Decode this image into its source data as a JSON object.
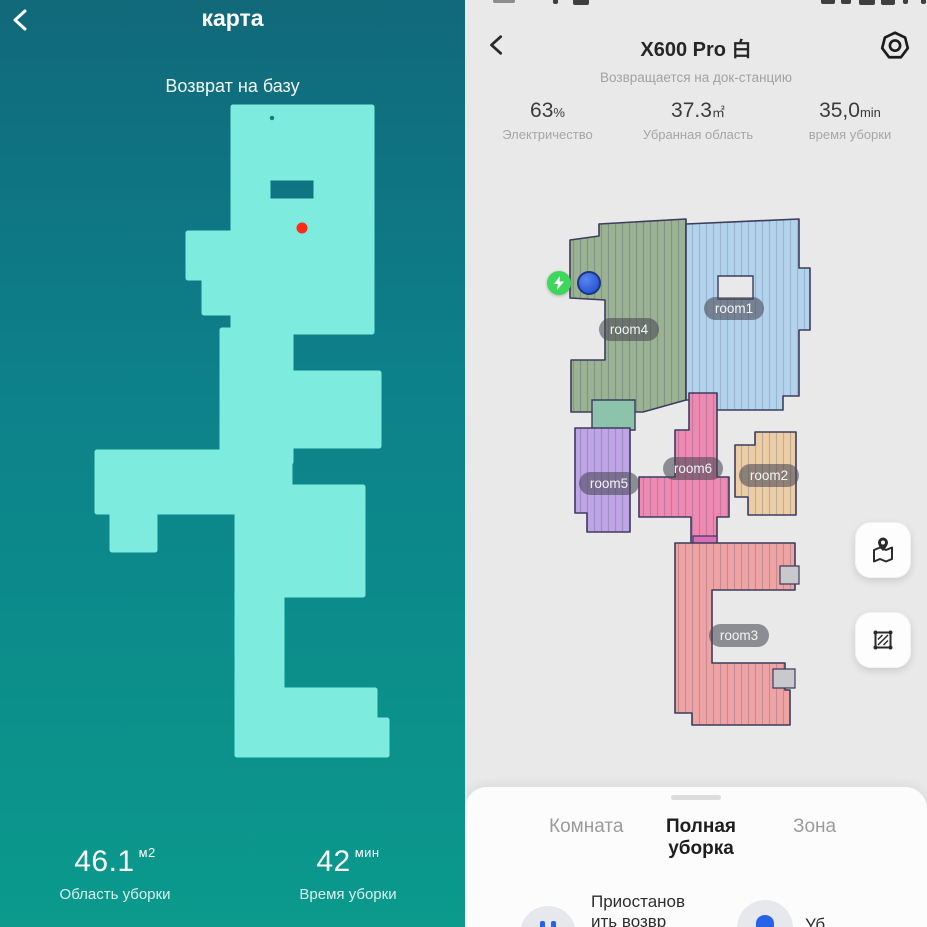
{
  "left_panel": {
    "title": "карта",
    "status": "Возврат на базу",
    "stats": [
      {
        "value": "46.1",
        "unit": "м2",
        "label": "Область уборки"
      },
      {
        "value": "42",
        "unit": "мин",
        "label": "Время уборки"
      }
    ]
  },
  "right_panel": {
    "title": "X600 Pro 白",
    "status": "Возвращается на док-станцию",
    "stats": [
      {
        "value": "63",
        "unit": "%",
        "label": "Электричество"
      },
      {
        "value": "37.3",
        "unit": "㎡",
        "label": "Убранная область"
      },
      {
        "value": "35,0",
        "unit": "min",
        "label": "время уборки"
      }
    ],
    "rooms": [
      {
        "label": "room4",
        "color": "#9bb392"
      },
      {
        "label": "room1",
        "color": "#b3d2ec"
      },
      {
        "label": "room6",
        "color": "#ee8ab2"
      },
      {
        "label": "room5",
        "color": "#bfa5e6"
      },
      {
        "label": "room2",
        "color": "#edcda6"
      },
      {
        "label": "room3",
        "color": "#f0a3a3"
      }
    ],
    "tabs": [
      {
        "label": "Комната",
        "active": false
      },
      {
        "label": "Полная уборка",
        "active": true
      },
      {
        "label": "Зона",
        "active": false
      }
    ],
    "actions": [
      {
        "label": "Приостанов ить возвр"
      },
      {
        "label": "Уб"
      }
    ]
  },
  "colors": {
    "left_bg_top": "#11697a",
    "left_bg_bottom": "#0b9a8c",
    "left_map": "#7debdd",
    "red_dot": "#fe2b16",
    "green_patch": "#8cc3ab",
    "magenta_patch": "#d86fb8",
    "dock_green": "#3ed65c",
    "robot_blue": "#1b55dc",
    "action_blue": "#2663e8"
  }
}
